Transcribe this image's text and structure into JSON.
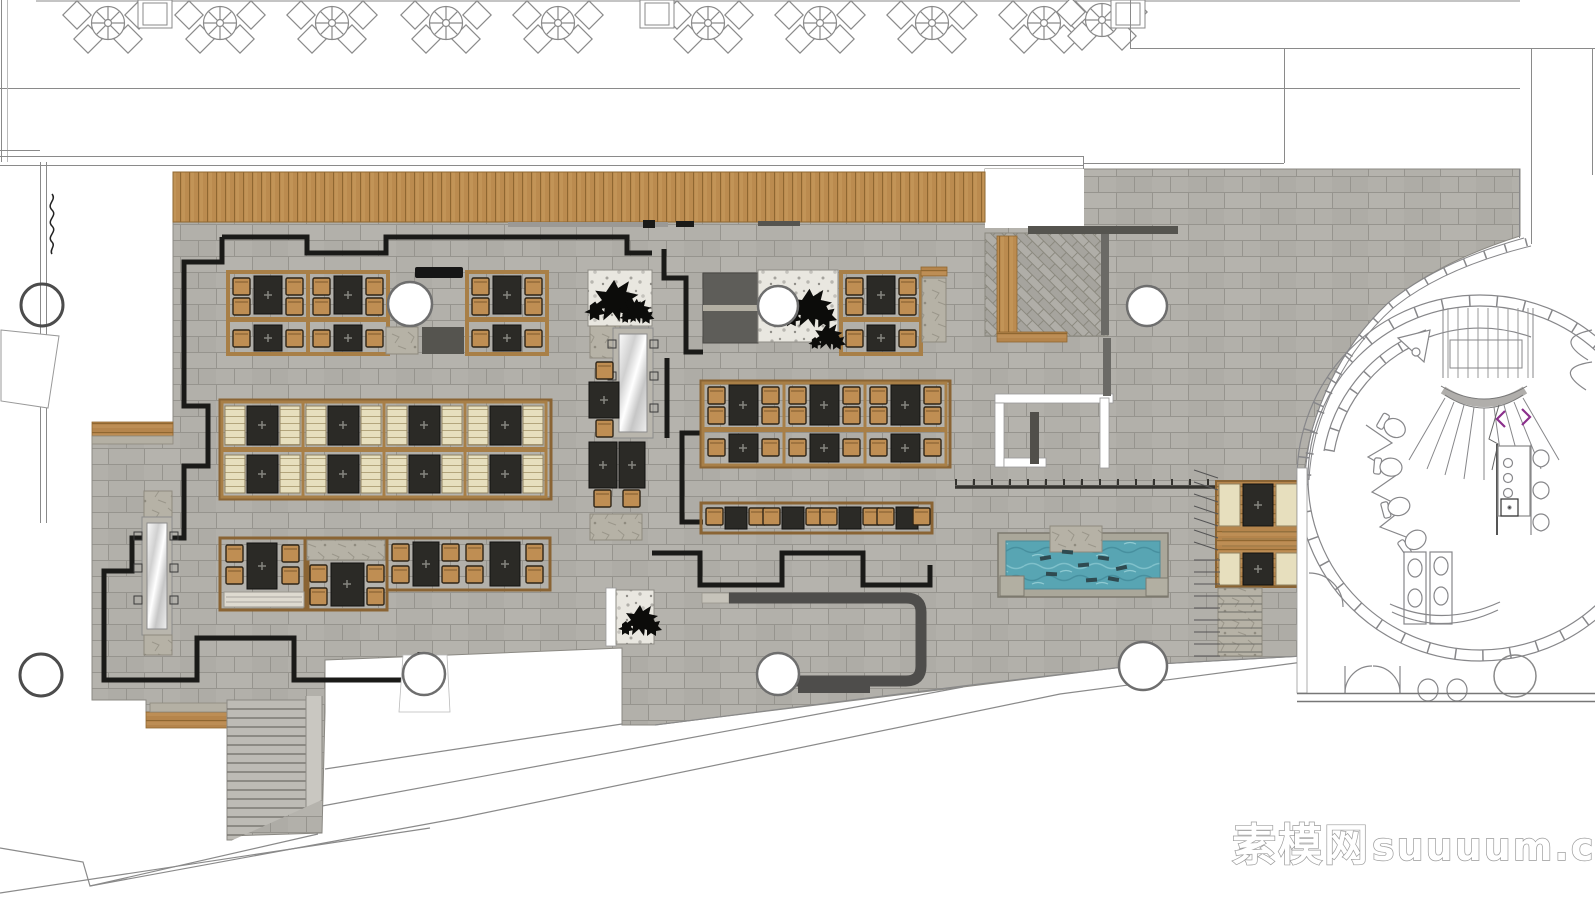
{
  "document": {
    "kind": "restaurant-interior-floor-plan"
  },
  "watermark": {
    "cjk": "素模网",
    "latin": "suuuum.com"
  },
  "palette": {
    "floor_tile": "#b2b0aa",
    "tile_grout": "#96948e",
    "deck_wood": "#bb8b4f",
    "furniture_wood_frame": "#a87f47",
    "table_dark": "#2b2a26",
    "chair_tan": "#bf8e53",
    "banquette_cream": "#e7dfbe",
    "panel_dark_gray": "#5e5d59",
    "bench_dark_gray": "#4e4d4b",
    "pool_water": "#58a5b3",
    "wall_black": "#1a1a18",
    "thin_line_gray": "#8a8a8a",
    "plant_black": "#0c0c0a",
    "stone_pad": "#b6b2a6",
    "watermark_fill": "#ffffff",
    "watermark_outline": "#9b9b9b",
    "stair_arrow_purple": "#8b2f8b"
  },
  "counts": {
    "terrace_parasol_tables": 10,
    "banquette_bays": 4,
    "central_dining_bays": 3,
    "pool_stepping_stones": 8,
    "round_columns": 9
  }
}
